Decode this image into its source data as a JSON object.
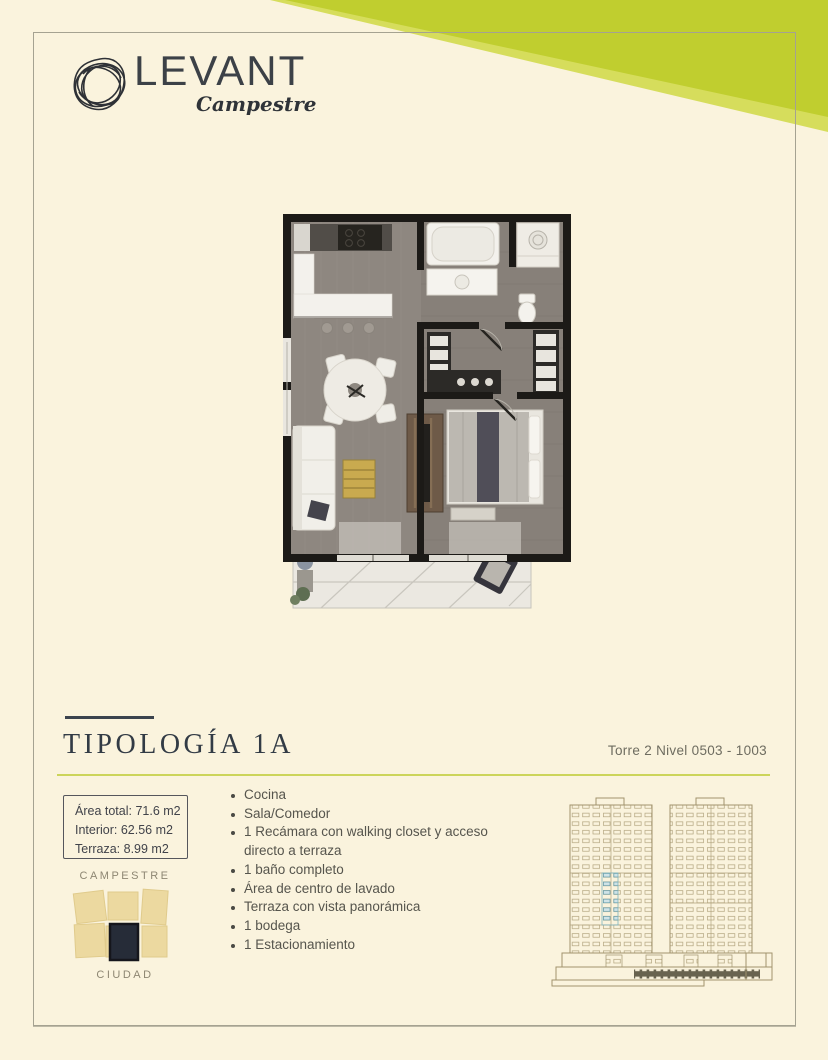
{
  "page": {
    "background_color": "#faf3dd",
    "accent_green": "#c0ce2f",
    "border_color": "#a5a291"
  },
  "header": {
    "brand_name": "LEVANT",
    "brand_subtitle": "Campestre"
  },
  "section": {
    "title": "TIPOLOGÍA 1A",
    "tower_info": "Torre 2 Nivel 0503 - 1003"
  },
  "area_box": {
    "line1": "Área total: 71.6 m2",
    "line2": "Interior: 62.56 m2",
    "line3": "Terraza: 8.99 m2"
  },
  "features": [
    "Cocina",
    "Sala/Comedor",
    "1 Recámara con walking closet y acceso directo a terraza",
    "1 baño completo",
    "Área de centro de lavado",
    "Terraza con vista panorámica",
    "1 bodega",
    "1 Estacionamiento"
  ],
  "location_diagram": {
    "top_label": "CAMPESTRE",
    "bottom_label": "CIUDAD"
  }
}
